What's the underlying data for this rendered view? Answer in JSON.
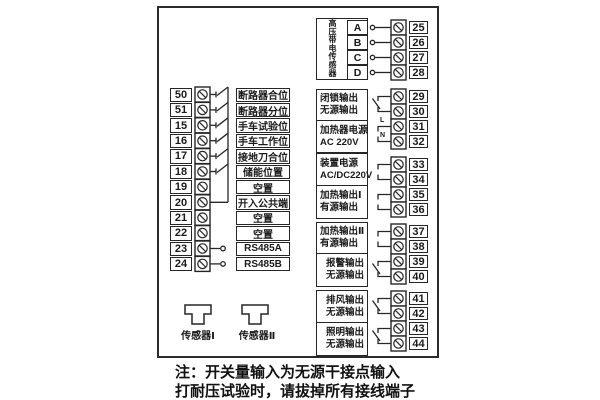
{
  "diagram": {
    "type": "terminal-wiring-diagram",
    "note_line1": "注：开关量输入为无源干接点输入",
    "note_line2": "打耐压试验时，请拔掉所有接线端子"
  },
  "colors": {
    "line": "#262626",
    "background": "#ffffff",
    "text": "#1a1a1a"
  },
  "left_inputs": {
    "rows": [
      {
        "terminal": "50",
        "label": "断路器合位"
      },
      {
        "terminal": "51",
        "label": "断路器分位"
      },
      {
        "terminal": "15",
        "label": "手车试验位"
      },
      {
        "terminal": "16",
        "label": "手车工作位"
      },
      {
        "terminal": "17",
        "label": "接地刀合位"
      },
      {
        "terminal": "18",
        "label": "储能位置"
      },
      {
        "terminal": "19",
        "label": "空置"
      },
      {
        "terminal": "20",
        "label": "开入公共端"
      },
      {
        "terminal": "21",
        "label": "空置"
      },
      {
        "terminal": "22",
        "label": "空置"
      },
      {
        "terminal": "23",
        "label": "RS485A"
      },
      {
        "terminal": "24",
        "label": "RS485B"
      }
    ]
  },
  "hv_sensor": {
    "label": "高压带电传感器",
    "channels": [
      {
        "name": "A",
        "terminal": "25"
      },
      {
        "name": "B",
        "terminal": "26"
      },
      {
        "name": "C",
        "terminal": "27"
      },
      {
        "name": "D",
        "terminal": "28"
      }
    ]
  },
  "output_groups": [
    {
      "sections": [
        {
          "line1": "闭锁输出",
          "line2": "无源输出",
          "t1": "29",
          "t2": "30",
          "contact": "relay"
        },
        {
          "line1": "加热器电源",
          "line2": "AC 220V",
          "t1": "31",
          "t2": "32",
          "contact": "power",
          "mark1": "L",
          "mark2": "N"
        }
      ]
    },
    {
      "sections": [
        {
          "line1": "装置电源",
          "line2": "AC/DC220V",
          "t1": "33",
          "t2": "34",
          "contact": "power"
        },
        {
          "line1": "加热输出Ⅰ",
          "line2": "有源输出",
          "t1": "35",
          "t2": "36",
          "contact": "power"
        }
      ]
    },
    {
      "sections": [
        {
          "line1": "加热输出Ⅱ",
          "line2": "有源输出",
          "t1": "37",
          "t2": "38",
          "contact": "power"
        },
        {
          "line1": "报警输出",
          "line2": "无源输出",
          "t1": "39",
          "t2": "40",
          "contact": "relay"
        }
      ]
    },
    {
      "sections": [
        {
          "line1": "排风输出",
          "line2": "无源输出",
          "t1": "41",
          "t2": "42",
          "contact": "relay"
        },
        {
          "line1": "照明输出",
          "line2": "无源输出",
          "t1": "43",
          "t2": "44",
          "contact": "relay"
        }
      ]
    }
  ],
  "bottom_sensors": [
    {
      "label": "传感器Ⅰ"
    },
    {
      "label": "传感器Ⅱ"
    }
  ]
}
